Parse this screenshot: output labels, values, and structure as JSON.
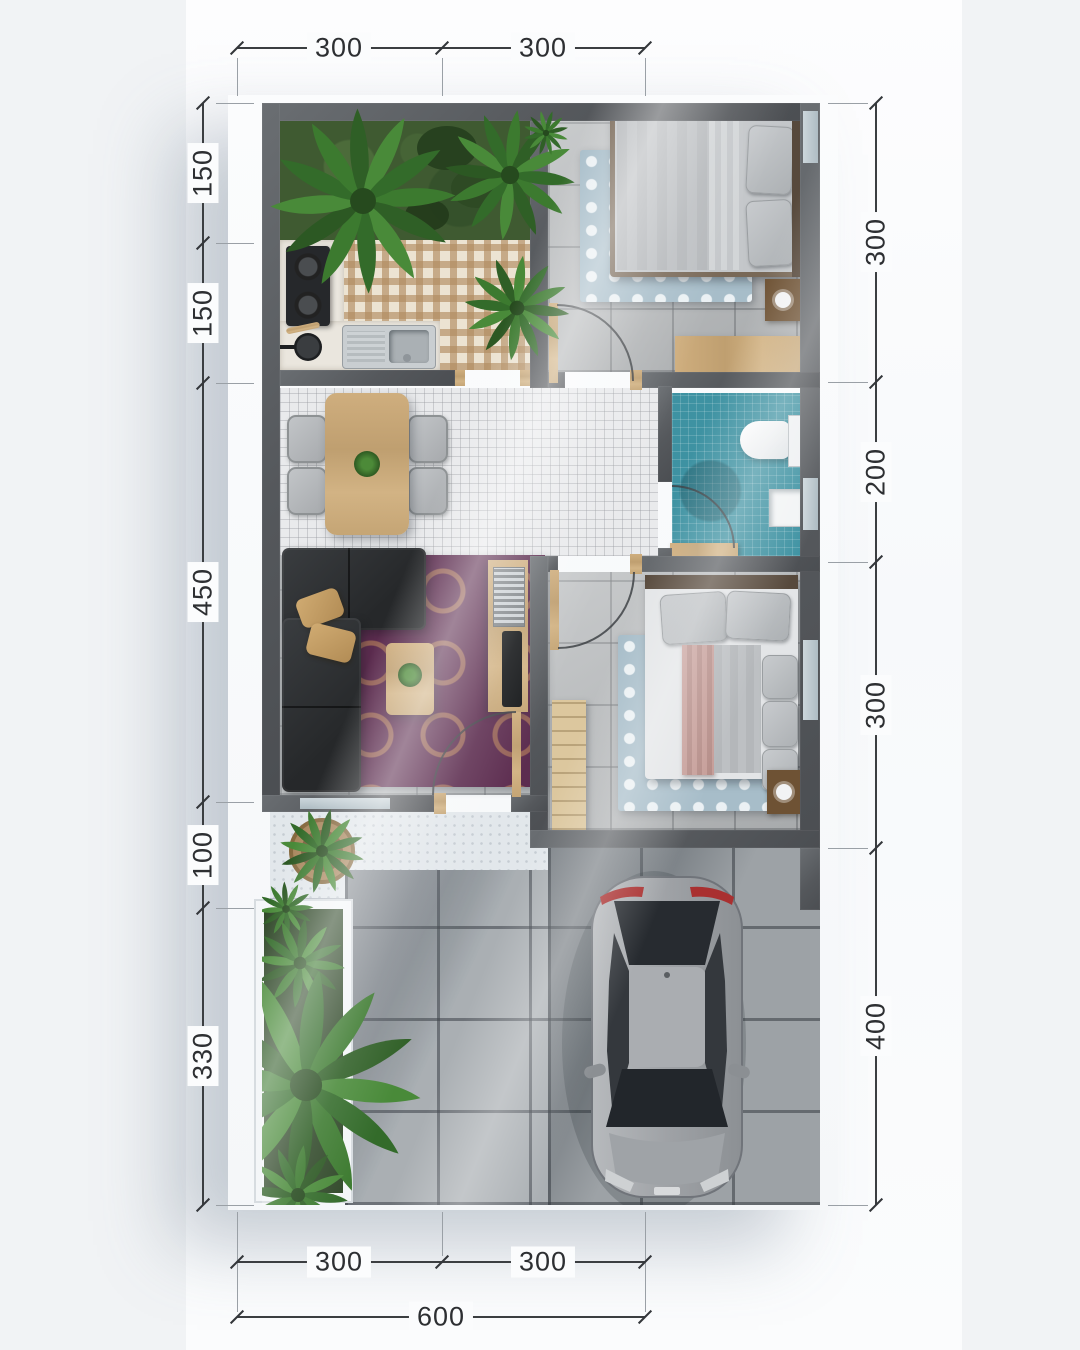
{
  "figure": {
    "type": "floor-plan-top-view",
    "units_note": "dimension numerals as printed on the drawing"
  },
  "dimensions": {
    "top": [
      "300",
      "300"
    ],
    "left": [
      "150",
      "150",
      "450",
      "100",
      "330"
    ],
    "right": [
      "300",
      "200",
      "300",
      "400"
    ],
    "bottom_inner": [
      "300",
      "300"
    ],
    "bottom_total": [
      "600"
    ]
  },
  "palette": {
    "wall": "#55585c",
    "grass": "#3f5a31",
    "bathroom_tile": "#3e92a2",
    "living_rug": "#5c2c4f",
    "bedroom_rug": "#a7bdc9",
    "wood": "#c5a575",
    "sofa": "#2c2e30",
    "car_body": "#a3a6a9",
    "floor_tile": "#b4b7b9",
    "mosaic": "#e9eaec",
    "kitchen_tile": "#d9c3a4",
    "terrace": "#e2e7eb",
    "paving": "#9da2a6",
    "dimension_line": "#3b3e41",
    "dimension_text": "#2d2f32"
  }
}
